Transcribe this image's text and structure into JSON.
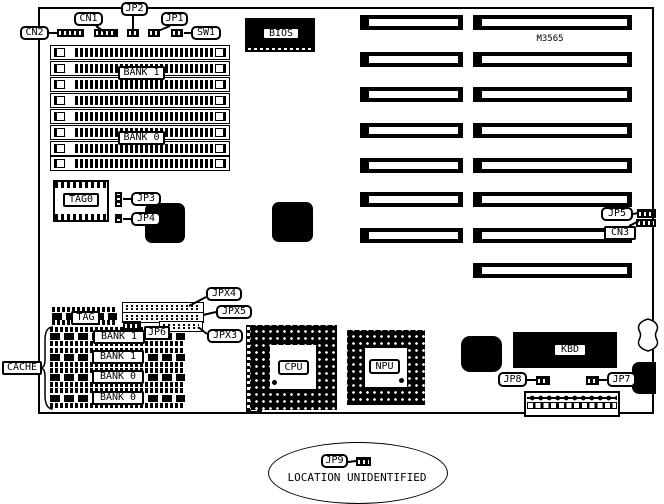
{
  "board": {
    "model": "M3565",
    "ink": "#000000",
    "paper": "#ffffff"
  },
  "chips": {
    "bios": "BIOS",
    "cpu": "CPU",
    "npu": "NPU",
    "kbd": "KBD"
  },
  "memory": {
    "bank1": "BANK 1",
    "bank0": "BANK 0"
  },
  "cache": {
    "label": "CACHE",
    "tag0": "TAG0",
    "tag": "TAG",
    "banks": [
      "BANK 1",
      "BANK 1",
      "BANK 0",
      "BANK 0"
    ]
  },
  "connectors": {
    "cn1": "CN1",
    "cn2": "CN2",
    "cn3": "CN3",
    "sw1": "SW1",
    "jp1": "JP1",
    "jp2": "JP2",
    "jp3": "JP3",
    "jp4": "JP4",
    "jp5": "JP5",
    "jp6": "JP6",
    "jp7": "JP7",
    "jp8": "JP8",
    "jp9": "JP9",
    "jpx3": "JPX3",
    "jpx4": "JPX4",
    "jpx5": "JPX5"
  },
  "note": {
    "text": "LOCATION UNIDENTIFIED"
  }
}
